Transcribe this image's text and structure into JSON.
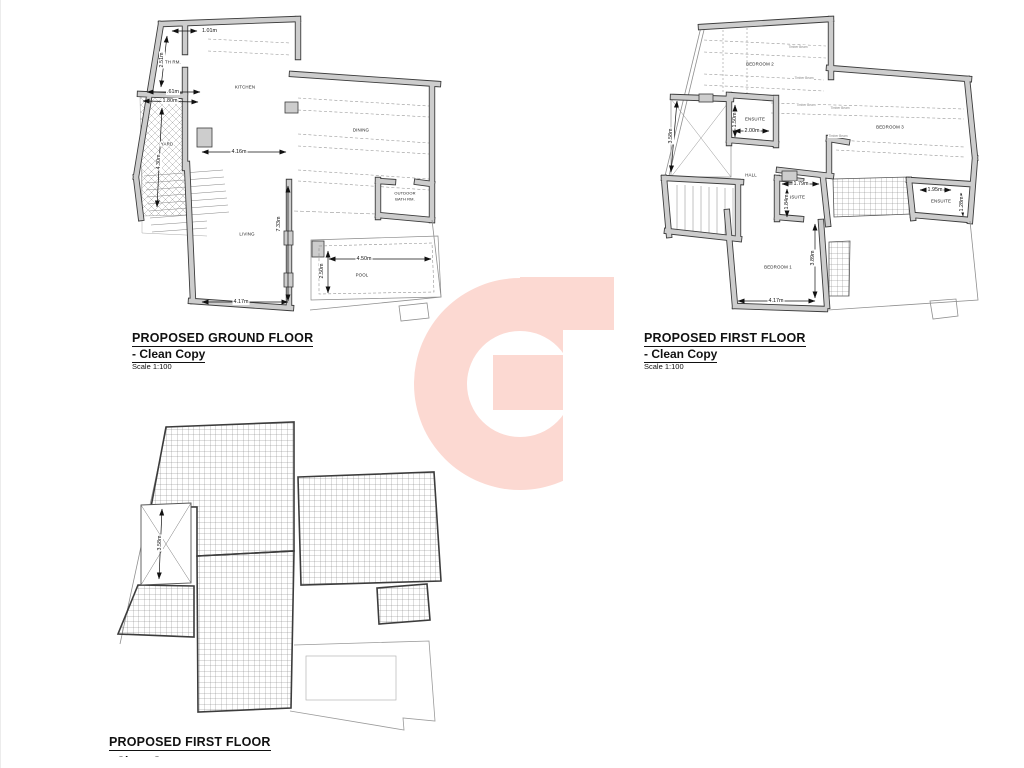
{
  "watermark": {
    "name": "g-logo",
    "color": "#fcd9d2"
  },
  "plans": {
    "ground": {
      "title": "PROPOSED GROUND FLOOR",
      "subtitle": "- Clean Copy",
      "scale": "Scale 1:100",
      "rooms": {
        "bath": "BATH RM.",
        "kitchen": "KITCHEN",
        "dining": "DINING",
        "yard": "YARD",
        "living": "LIVING",
        "outdoor_bath_line1": "OUTDOOR",
        "outdoor_bath_line2": "BATH RM.",
        "pool": "POOL"
      },
      "dims": {
        "top": "1.01m",
        "bath_w": ".61m",
        "bath_h": "2.51m",
        "yard_w": "1.80m",
        "yard_h": "4.30m",
        "kitchen_w": "4.16m",
        "living_h": "7.33m",
        "living_w": "4.17m",
        "pool_w": "4.50m",
        "pool_h": "2.50m"
      }
    },
    "first": {
      "title": "PROPOSED FIRST FLOOR",
      "subtitle": "- Clean Copy",
      "scale": "Scale 1:100",
      "rooms": {
        "bedroom1": "BEDROOM 1",
        "bedroom2": "BEDROOM 2",
        "bedroom3": "BEDROOM 3",
        "hall": "HALL",
        "ensuite": "ENSUITE"
      },
      "dims": {
        "ensuite2_w": "2.00m",
        "ensuite2_h": "1.50m",
        "shaft_h": "3.58m",
        "ensuiteL_w": "1.79m",
        "ensuiteL_h": "1.84m",
        "ensuiteR_w": "1.95m",
        "ensuiteR_h": "1.28m",
        "bedroom1_h": "3.89m",
        "bedroom1_w": "4.17m"
      },
      "beam_label": "Timber Beam"
    },
    "roof": {
      "title": "PROPOSED FIRST FLOOR",
      "subtitle": "- Clean Copy",
      "scale": "Scale 1:100",
      "dims": {
        "shaft_h": "3.58m"
      }
    }
  }
}
